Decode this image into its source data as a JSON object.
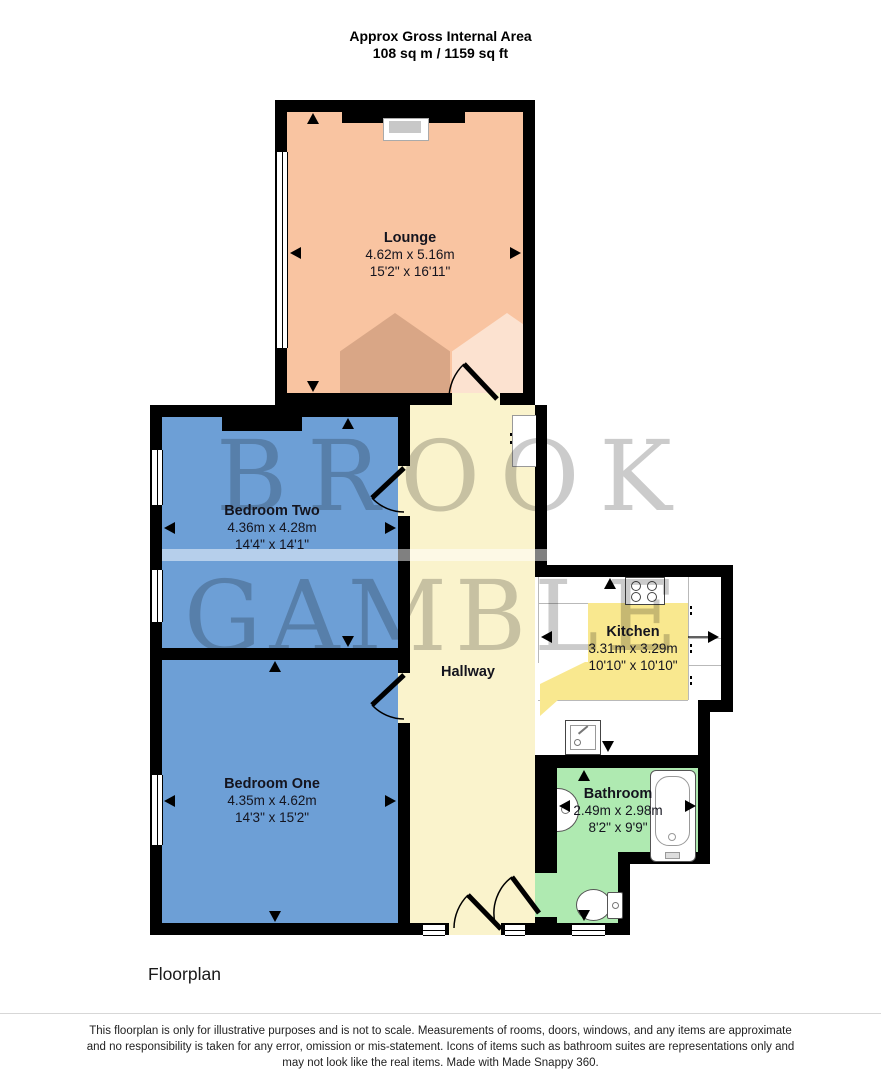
{
  "header": {
    "line1": "Approx Gross Internal Area",
    "line2": "108 sq m / 1159 sq ft"
  },
  "rooms": {
    "lounge": {
      "name": "Lounge",
      "metric": "4.62m x 5.16m",
      "imperial": "15'2\" x 16'11\""
    },
    "bedroom_two": {
      "name": "Bedroom Two",
      "metric": "4.36m x 4.28m",
      "imperial": "14'4\" x 14'1\""
    },
    "bedroom_one": {
      "name": "Bedroom One",
      "metric": "4.35m x 4.62m",
      "imperial": "14'3\" x 15'2\""
    },
    "kitchen": {
      "name": "Kitchen",
      "metric": "3.31m x 3.29m",
      "imperial": "10'10\" x 10'10\""
    },
    "bathroom": {
      "name": "Bathroom",
      "metric": "2.49m x 2.98m",
      "imperial": "8'2\" x 9'9\""
    },
    "hallway": {
      "name": "Hallway"
    }
  },
  "watermark": {
    "line1": "BROOK",
    "line2": "GAMBLE"
  },
  "footer": {
    "label": "Floorplan",
    "disclaimer": [
      "This floorplan is only for illustrative purposes and is not to scale. Measurements of rooms, doors, windows, and any items are approximate",
      "and no responsibility is taken for any error, omission or mis-statement. Icons of items such as bathroom suites are representations only and",
      "may not look like the real items. Made with Made Snappy 360."
    ]
  },
  "colors": {
    "wall": "#000000",
    "lounge": "#F9C4A1",
    "bedroom": "#6D9FD6",
    "hallway": "#FAF3CC",
    "kitchen_floor": "#F9E88F",
    "bathroom": "#AFEAB1",
    "watermark": "#7D7D7D"
  }
}
